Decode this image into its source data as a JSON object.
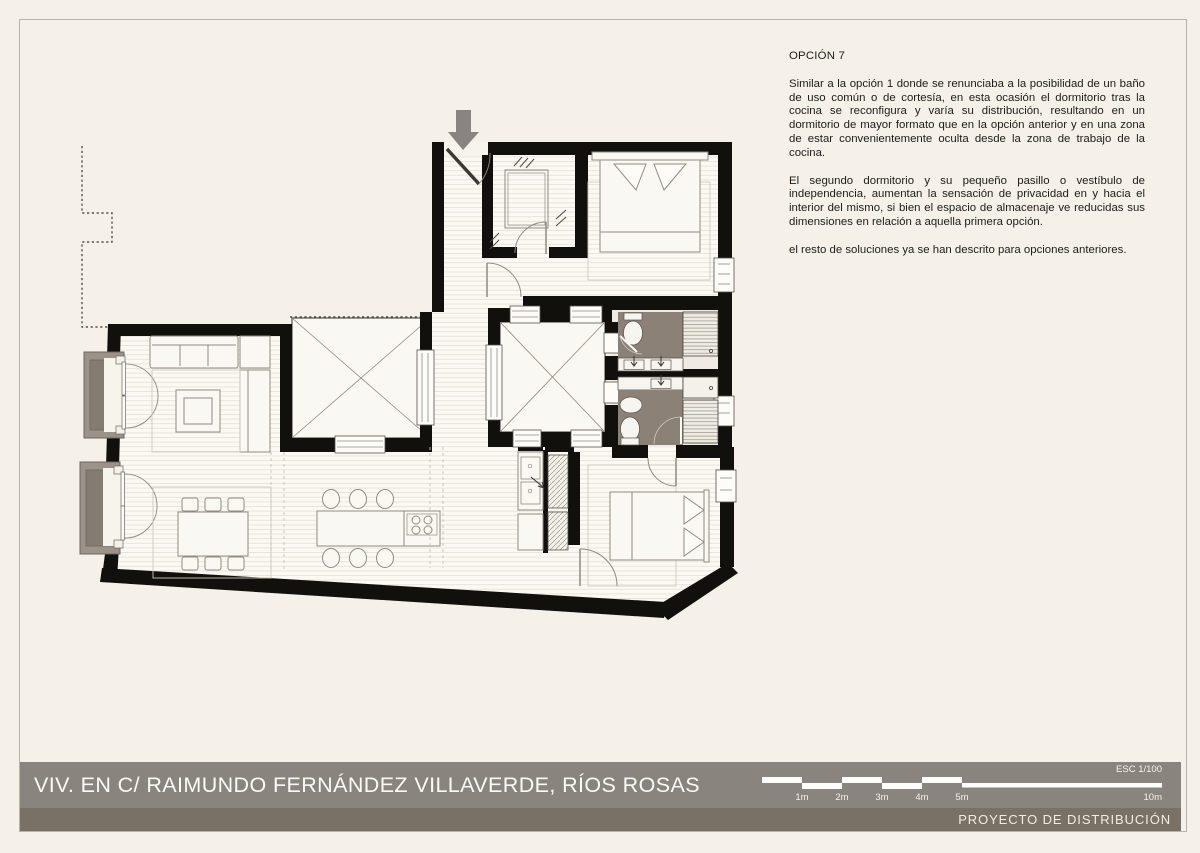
{
  "header": {
    "option_label": "OPCIÓN 7"
  },
  "notes": {
    "p1": "Similar a la opción 1 donde se renunciaba a la posibilidad de un baño de uso común o de cortesía, en esta ocasión el dormitorio tras la cocina se reconfigura y varía su distribución, resultando en un dormitorio de mayor formato que en la opción anterior y en una zona de estar convenientemente oculta desde la zona de trabajo de la cocina.",
    "p2": "El segundo dormitorio y su pequeño pasillo o vestíbulo de independencia, aumentan la sensación de privacidad en y hacia el interior del mismo, si bien el espacio de almacenaje ve reducidas sus dimensiones en relación a aquella primera opción.",
    "p3": "el resto de soluciones ya se han descrito para opciones anteriores."
  },
  "titlebar": {
    "title": "VIV. EN C/ RAIMUNDO FERNÁNDEZ VILLAVERDE, RÍOS ROSAS"
  },
  "scalebar": {
    "esc": "ESC 1/100",
    "m1": "1m",
    "m2": "2m",
    "m3": "3m",
    "m4": "4m",
    "m5": "5m",
    "m10": "10m"
  },
  "footer": {
    "label": "PROYECTO DE DISTRIBUCIÓN"
  },
  "colors": {
    "background": "#f5f1e8",
    "title_bar_gray": "#8a847e",
    "footer_bar_dark": "#7a7166",
    "wall_black": "#12100d",
    "bathroom_gray": "#8b8176",
    "balcony_gray": "#9b938a",
    "text_dark": "#1d1c1a",
    "scale_white": "#ffffff"
  }
}
